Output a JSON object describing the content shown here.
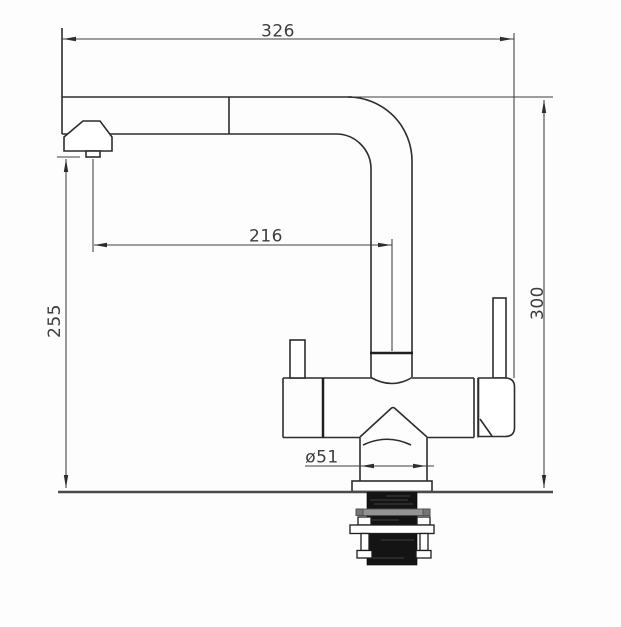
{
  "dimensions": {
    "overall_width_mm": "326",
    "spout_reach_mm": "216",
    "outlet_height_mm": "255",
    "overall_height_mm": "300",
    "base_diameter": "ø51"
  }
}
